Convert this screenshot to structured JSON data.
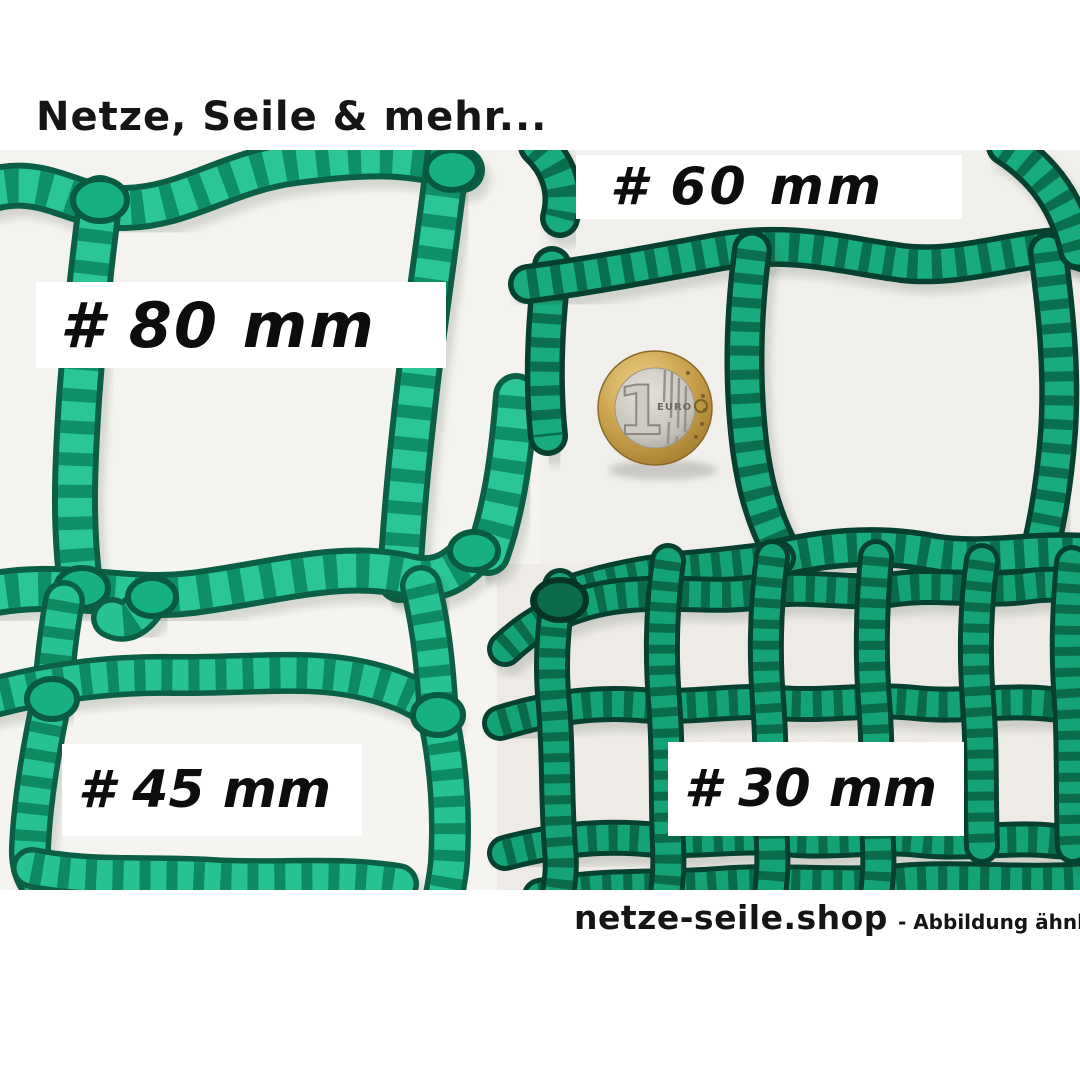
{
  "brand": {
    "header": "Netze, Seile & mehr...",
    "footer_site": "netze-seile.shop",
    "footer_note": "- Abbildung ähnlich"
  },
  "mesh_labels": {
    "mesh80": "# 80 mm",
    "mesh60": "# 60 mm",
    "mesh45": "# 45 mm",
    "mesh30": "# 30 mm"
  },
  "mesh_sizes_mm": [
    80,
    60,
    45,
    30
  ],
  "coin": {
    "value": "1",
    "currency": "EURO"
  },
  "colors": {
    "net_bright_light": "#2bc697",
    "net_bright_dark": "#0a5f45",
    "net_dark_light": "#17ab7e",
    "net_dark_dark": "#06402e",
    "coin_gold": "#c9a14c",
    "coin_silver": "#c6c3bb",
    "photo_background": "#f5f3f0",
    "page_background": "#ffffff",
    "text": "#151515"
  }
}
